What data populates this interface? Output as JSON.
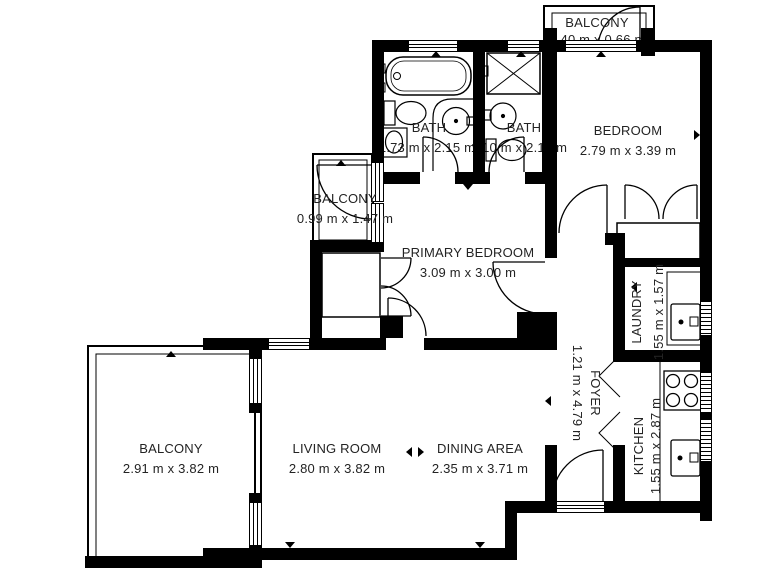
{
  "colors": {
    "wall": "#000000",
    "background": "#ffffff",
    "text": "#232323"
  },
  "rooms": {
    "balcony_top": {
      "name": "BALCONY",
      "dims": "40 m x 0.66 m"
    },
    "bath1": {
      "name": "BATH",
      "dims": "1.73 m x 2.15 m"
    },
    "bath2": {
      "name": "BATH",
      "dims": "1.10 m x 2.15 m"
    },
    "bedroom": {
      "name": "BEDROOM",
      "dims": "2.79 m x 3.39 m"
    },
    "balcony_mid": {
      "name": "BALCONY",
      "dims": "0.99 m x 1.47 m"
    },
    "primary_bedroom": {
      "name": "PRIMARY BEDROOM",
      "dims": "3.09 m x 3.00 m"
    },
    "laundry": {
      "name": "LAUNDRY",
      "dims": "1.55 m x 1.57 m"
    },
    "foyer": {
      "name": "FOYER",
      "dims": "1.21 m x 4.79 m"
    },
    "kitchen": {
      "name": "KITCHEN",
      "dims": "1.55 m x 2.87 m"
    },
    "living_room": {
      "name": "LIVING ROOM",
      "dims": "2.80 m x 3.82 m"
    },
    "dining_area": {
      "name": "DINING AREA",
      "dims": "2.35 m x 3.71 m"
    },
    "balcony_bottom": {
      "name": "BALCONY",
      "dims": "2.91 m x 3.82 m"
    }
  }
}
